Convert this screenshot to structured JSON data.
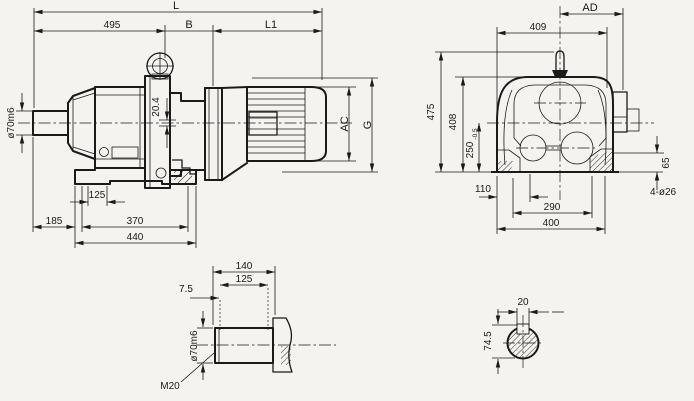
{
  "colors": {
    "background": "#f4f3f0",
    "line": "#1a1a1a"
  },
  "side_view": {
    "dim_L": "L",
    "dim_495": "495",
    "dim_B": "B",
    "dim_L1": "L1",
    "dim_shaft": "ø70m6",
    "dim_key": "20.4",
    "dim_AC": "AC",
    "dim_G": "G",
    "dim_125": "125",
    "dim_185": "185",
    "dim_370": "370",
    "dim_440": "440"
  },
  "end_view": {
    "dim_AD": "AD",
    "dim_409": "409",
    "dim_475": "475",
    "dim_408": "408",
    "dim_250": "250",
    "dim_250_tol": "-0.5",
    "dim_110": "110",
    "dim_290": "290",
    "dim_400": "400",
    "dim_65": "65",
    "dim_holes": "4-ø26"
  },
  "shaft_detail": {
    "dim_140": "140",
    "dim_125": "125",
    "dim_7_5": "7.5",
    "dim_shaft": "ø70m6",
    "dim_thread": "M20"
  },
  "shaft_section": {
    "dim_20": "20",
    "dim_74_5": "74.5"
  }
}
